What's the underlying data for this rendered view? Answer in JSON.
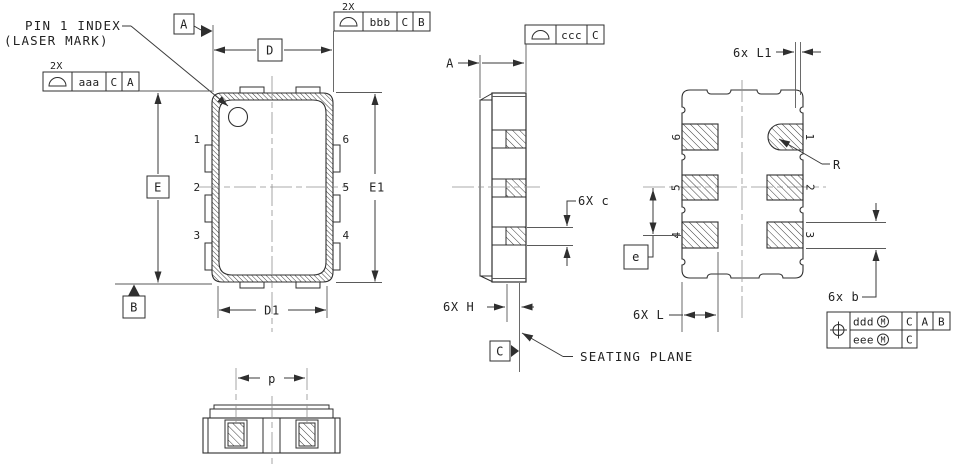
{
  "colors": {
    "line": "#2f2f2f",
    "centerline": "#909090",
    "text": "#222222",
    "background": "#ffffff"
  },
  "top_view": {
    "pin1_callout": {
      "line1": "PIN 1 INDEX",
      "line2": "(LASER MARK)"
    },
    "fcf_left": {
      "qty": "2X",
      "symbol": "profile-of-a-surface",
      "tolerance": "aaa",
      "datum_primary": "C",
      "datum_secondary": "A"
    },
    "fcf_top": {
      "qty": "2X",
      "symbol": "profile-of-a-surface",
      "tolerance": "bbb",
      "datum_primary": "C",
      "datum_secondary": "B"
    },
    "datum_a": "A",
    "datum_b": "B",
    "dims": {
      "d": "D",
      "d1": "D1",
      "e": "E",
      "e1": "E1"
    },
    "pins": {
      "p1": "1",
      "p2": "2",
      "p3": "3",
      "p4": "4",
      "p5": "5",
      "p6": "6"
    }
  },
  "side_view": {
    "fcf": {
      "symbol": "profile-of-a-surface",
      "tolerance": "ccc",
      "datum_primary": "C"
    },
    "dims": {
      "a": "A",
      "c": "6X c",
      "h": "6X H"
    },
    "datum_c": "C",
    "seating_plane_label": "SEATING PLANE"
  },
  "bottom_view": {
    "dims": {
      "l1": "6x L1",
      "r": "R",
      "l": "6X L",
      "b": "6x b",
      "pitch": "e"
    },
    "pins": {
      "p1": "1",
      "p2": "2",
      "p3": "3",
      "p4": "4",
      "p5": "5",
      "p6": "6"
    },
    "fcf_position": {
      "symbol": "true-position",
      "row1": {
        "tolerance": "ddd",
        "modifier": "M",
        "datum1": "C",
        "datum2": "A",
        "datum3": "B"
      },
      "row2": {
        "tolerance": "eee",
        "modifier": "M",
        "datum1": "C"
      }
    }
  },
  "front_view": {
    "dims": {
      "p": "p"
    }
  }
}
